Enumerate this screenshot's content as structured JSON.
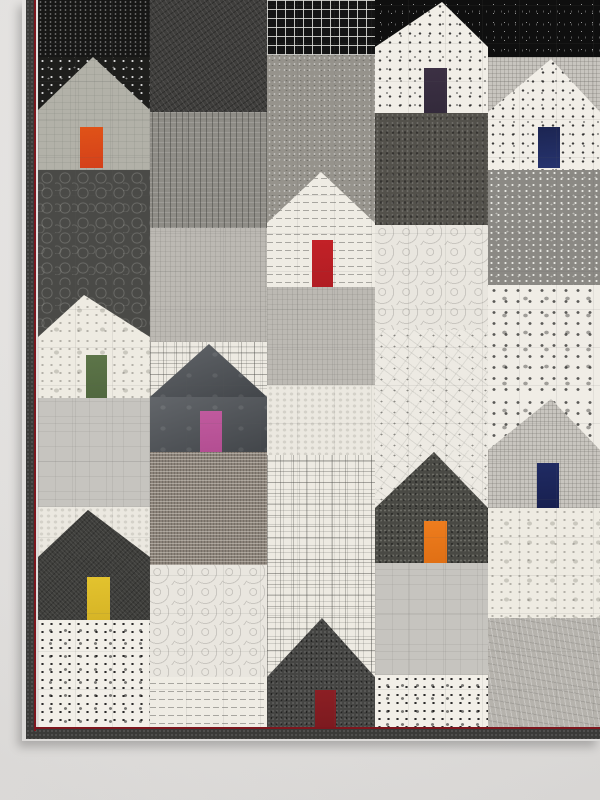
{
  "scene": {
    "description": "Photograph of a modern patchwork quilt hanging on a pale gray wall. The quilt is pieced from black, white and gray printed fabrics forming a village of ten house blocks, each house with a single brightly colored door (orange, plum, navy, red, green, pink, orange, yellow and dark red). A charcoal binding with a thin dark-red accent stripe edges the quilt on the left and bottom."
  },
  "wall": {
    "color_top": "#eae8e6",
    "color_bottom": "#e1dfdd"
  },
  "quilt": {
    "left": 26,
    "top": 0,
    "width": 574,
    "height": 739,
    "fabric_area": {
      "x": 38,
      "y": 0,
      "w": 562,
      "h": 728
    },
    "binding": {
      "color": "#3a3a38",
      "accent_color": "#7d161d",
      "left_strip": {
        "x": 26,
        "y": 0,
        "w": 10,
        "h": 739
      },
      "left_accent": {
        "x": 34,
        "y": 0,
        "w": 2,
        "h": 731
      },
      "bottom_strip": {
        "x": 26,
        "y": 729,
        "w": 574,
        "h": 10
      },
      "bottom_accent": {
        "x": 36,
        "y": 727,
        "w": 564,
        "h": 2
      }
    },
    "quilting_grid_px": 37,
    "blocks": [
      {
        "name": "black-dot-rows",
        "x": 38,
        "y": 0,
        "w": 112,
        "h": 57,
        "fabric": "dotrows"
      },
      {
        "name": "charcoal-weave",
        "x": 150,
        "y": 0,
        "w": 117,
        "h": 112,
        "fabric": "weave"
      },
      {
        "name": "black-windowpane-grid",
        "x": 267,
        "y": 0,
        "w": 108,
        "h": 55,
        "fabric": "grid"
      },
      {
        "name": "black-speckle-behind-house-2",
        "x": 375,
        "y": 0,
        "w": 113,
        "h": 113,
        "fabric": "speckle"
      },
      {
        "name": "black-speckle-top-right",
        "x": 488,
        "y": 0,
        "w": 112,
        "h": 57,
        "fabric": "speckle"
      },
      {
        "name": "dotted-black-behind-house-1",
        "x": 38,
        "y": 57,
        "w": 112,
        "h": 113,
        "fabric": "dotblack"
      },
      {
        "name": "crosshatch-behind-house-3",
        "x": 488,
        "y": 57,
        "w": 112,
        "h": 113,
        "fabric": "crosshatch"
      },
      {
        "name": "gray-scribble-upper",
        "x": 267,
        "y": 55,
        "w": 108,
        "h": 115,
        "fabric": "scribble"
      },
      {
        "name": "gray-dash",
        "x": 150,
        "y": 112,
        "w": 117,
        "h": 116,
        "fabric": "dash"
      },
      {
        "name": "dark-scribble",
        "x": 375,
        "y": 113,
        "w": 113,
        "h": 112,
        "fabric": "darkscribble"
      },
      {
        "name": "pebble-dark",
        "x": 38,
        "y": 170,
        "w": 112,
        "h": 115,
        "fabric": "pebble"
      },
      {
        "name": "scribble-behind-house-4",
        "x": 267,
        "y": 170,
        "w": 108,
        "h": 117,
        "fabric": "scribble"
      },
      {
        "name": "gray-dotted",
        "x": 488,
        "y": 170,
        "w": 112,
        "h": 115,
        "fabric": "graydotted"
      },
      {
        "name": "linen-gray-left",
        "x": 150,
        "y": 228,
        "w": 117,
        "h": 114,
        "fabric": "linen"
      },
      {
        "name": "white-swirl-upper",
        "x": 375,
        "y": 225,
        "w": 113,
        "h": 105,
        "fabric": "swirl"
      },
      {
        "name": "pebble-behind-house-5",
        "x": 38,
        "y": 285,
        "w": 112,
        "h": 113,
        "fabric": "pebble"
      },
      {
        "name": "linen-gray-center",
        "x": 267,
        "y": 287,
        "w": 108,
        "h": 98,
        "fabric": "linen"
      },
      {
        "name": "floral-dot-white",
        "x": 488,
        "y": 285,
        "w": 112,
        "h": 112,
        "fabric": "floraldot"
      },
      {
        "name": "square-print-behind-house-6",
        "x": 150,
        "y": 342,
        "w": 117,
        "h": 110,
        "fabric": "squareprint"
      },
      {
        "name": "constellation-white",
        "x": 375,
        "y": 330,
        "w": 113,
        "h": 120,
        "fabric": "constellation"
      },
      {
        "name": "grunge-white-center",
        "x": 267,
        "y": 385,
        "w": 108,
        "h": 70,
        "fabric": "grungewhite"
      },
      {
        "name": "solid-light-gray-left",
        "x": 38,
        "y": 398,
        "w": 112,
        "h": 109,
        "fabric": "solidgray"
      },
      {
        "name": "floral-dot-behind-house-7",
        "x": 488,
        "y": 397,
        "w": 112,
        "h": 111,
        "fabric": "floraldot"
      },
      {
        "name": "constellation-behind-house-8",
        "x": 375,
        "y": 450,
        "w": 113,
        "h": 113,
        "fabric": "constellation"
      },
      {
        "name": "taupe-tweed",
        "x": 150,
        "y": 452,
        "w": 117,
        "h": 113,
        "fabric": "tweed"
      },
      {
        "name": "square-print-center",
        "x": 267,
        "y": 455,
        "w": 108,
        "h": 105,
        "fabric": "squareprint"
      },
      {
        "name": "grunge-white-behind-house-9",
        "x": 38,
        "y": 507,
        "w": 112,
        "h": 113,
        "fabric": "grungewhite"
      },
      {
        "name": "white-toile-right",
        "x": 488,
        "y": 508,
        "w": 112,
        "h": 110,
        "fabric": "toile"
      },
      {
        "name": "square-print-behind-house-10",
        "x": 267,
        "y": 560,
        "w": 108,
        "h": 168,
        "fabric": "squareprint"
      },
      {
        "name": "white-swirl-lower",
        "x": 150,
        "y": 565,
        "w": 117,
        "h": 112,
        "fabric": "swirl"
      },
      {
        "name": "solid-light-gray-lower",
        "x": 375,
        "y": 563,
        "w": 113,
        "h": 112,
        "fabric": "solidgray"
      },
      {
        "name": "dotted-square-white-left",
        "x": 38,
        "y": 620,
        "w": 112,
        "h": 108,
        "fabric": "dottedsq"
      },
      {
        "name": "text-print-strip",
        "x": 150,
        "y": 677,
        "w": 117,
        "h": 51,
        "fabric": "textprint"
      },
      {
        "name": "dotted-square-white-center",
        "x": 375,
        "y": 675,
        "w": 113,
        "h": 53,
        "fabric": "dottedsq"
      },
      {
        "name": "gray-crinkle",
        "x": 488,
        "y": 618,
        "w": 112,
        "h": 110,
        "fabric": "crinkle"
      }
    ],
    "houses": [
      {
        "name": "house-1-top-left",
        "x": 38,
        "w": 112,
        "peak_x": 93,
        "roof_top": 57,
        "roof_base": 110,
        "body_bottom": 170,
        "fabric": "grunge",
        "door": {
          "x": 80,
          "y": 127,
          "w": 23,
          "h": 41,
          "color": "#e05318",
          "color2": "#d4401a",
          "color_name": "orange"
        }
      },
      {
        "name": "house-2-top-center",
        "x": 375,
        "w": 113,
        "peak_x": 442,
        "roof_top": 2,
        "roof_base": 47,
        "body_bottom": 113,
        "fabric": "dottedwhite",
        "door": {
          "x": 424,
          "y": 68,
          "w": 23,
          "h": 45,
          "color": "#3c3044",
          "color2": "#332a3b",
          "color_name": "dark-plum"
        }
      },
      {
        "name": "house-3-top-right",
        "x": 488,
        "w": 112,
        "peak_x": 551,
        "roof_top": 59,
        "roof_base": 112,
        "body_bottom": 170,
        "fabric": "dottedwhite",
        "door": {
          "x": 538,
          "y": 127,
          "w": 22,
          "h": 41,
          "color": "#1c2552",
          "color2": "#26336e",
          "color_name": "navy-blue"
        }
      },
      {
        "name": "house-4-center-red",
        "x": 267,
        "w": 108,
        "peak_x": 321,
        "roof_top": 172,
        "roof_base": 223,
        "body_bottom": 287,
        "fabric": "textprint",
        "door": {
          "x": 312,
          "y": 240,
          "w": 21,
          "h": 47,
          "color": "#c32127",
          "color2": "#b01d23",
          "color_name": "red"
        }
      },
      {
        "name": "house-5-left-green",
        "x": 38,
        "w": 112,
        "peak_x": 84,
        "roof_top": 295,
        "roof_base": 337,
        "body_bottom": 398,
        "fabric": "toile",
        "door": {
          "x": 86,
          "y": 355,
          "w": 21,
          "h": 43,
          "color": "#5d7549",
          "color2": "#51683f",
          "color_name": "moss-green"
        }
      },
      {
        "name": "house-6-center-pink",
        "x": 150,
        "w": 117,
        "peak_x": 209,
        "roof_top": 344,
        "roof_base": 397,
        "body_bottom": 452,
        "fabric": "batikslate",
        "door": {
          "x": 200,
          "y": 411,
          "w": 22,
          "h": 41,
          "color": "#c05a9e",
          "color2": "#b34e92",
          "color_name": "pink"
        }
      },
      {
        "name": "house-7-right-navy",
        "x": 488,
        "w": 112,
        "peak_x": 551,
        "roof_top": 399,
        "roof_base": 450,
        "body_bottom": 508,
        "fabric": "crosshatch",
        "door": {
          "x": 537,
          "y": 463,
          "w": 22,
          "h": 45,
          "color": "#202b63",
          "color2": "#182050",
          "color_name": "royal-navy"
        }
      },
      {
        "name": "house-8-center-orange",
        "x": 375,
        "w": 113,
        "peak_x": 434,
        "roof_top": 452,
        "roof_base": 508,
        "body_bottom": 563,
        "fabric": "charcoaldense",
        "door": {
          "x": 424,
          "y": 521,
          "w": 23,
          "h": 42,
          "color": "#ee7d1e",
          "color2": "#e06f14",
          "color_name": "orange"
        }
      },
      {
        "name": "house-9-bottom-left-yellow",
        "x": 38,
        "w": 112,
        "peak_x": 88,
        "roof_top": 510,
        "roof_base": 557,
        "body_bottom": 620,
        "fabric": "charcoalfine",
        "door": {
          "x": 87,
          "y": 577,
          "w": 23,
          "h": 43,
          "color": "#e3c32e",
          "color2": "#d6b426",
          "color_name": "yellow"
        }
      },
      {
        "name": "house-10-bottom-dark-red",
        "x": 267,
        "w": 108,
        "peak_x": 322,
        "roof_top": 618,
        "roof_base": 677,
        "body_bottom": 728,
        "fabric": "blacktweed",
        "door": {
          "x": 315,
          "y": 690,
          "w": 21,
          "h": 38,
          "color": "#8c1f24",
          "color2": "#7c1a1f",
          "color_name": "dark-red"
        }
      }
    ]
  }
}
